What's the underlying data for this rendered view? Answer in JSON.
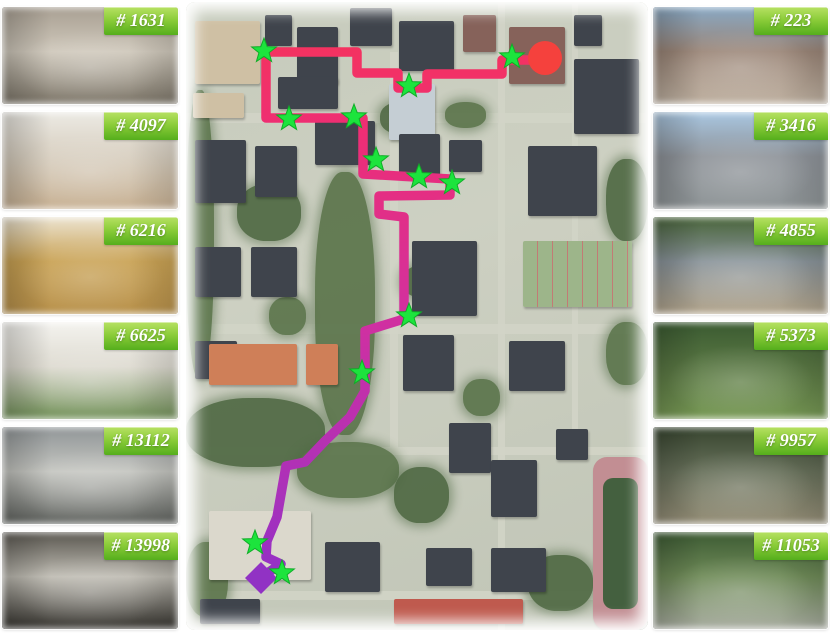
{
  "figure": {
    "background": "#ffffff",
    "badge": {
      "text_color": "#ffffff",
      "gradient": [
        "#b7e163",
        "#8ccd3a",
        "#55ae1c"
      ]
    }
  },
  "left_column": {
    "frames": [
      {
        "id": "# 1631",
        "scene": "old stairwell, stained walls, metal railing",
        "palette": [
          "#a89f92",
          "#cfc8bb",
          "#7b7467"
        ]
      },
      {
        "id": "# 4097",
        "scene": "cafeteria hall with tables and stools",
        "palette": [
          "#eceae4",
          "#d8cfc0",
          "#c7b092"
        ]
      },
      {
        "id": "# 6216",
        "scene": "wood-panel staircase with white railing",
        "palette": [
          "#ece4d2",
          "#c9a254",
          "#b8914b"
        ]
      },
      {
        "id": "# 6625",
        "scene": "bright lobby with ivy planter hedge",
        "palette": [
          "#f4f3ef",
          "#dedbd1",
          "#6f8f55"
        ]
      },
      {
        "id": "# 13112",
        "scene": "columned hall with striped stone floor",
        "palette": [
          "#909597",
          "#c5c6c1",
          "#5e615d"
        ]
      },
      {
        "id": "# 13998",
        "scene": "atrium stair with curved black floor bands",
        "palette": [
          "#59564f",
          "#bfbcb3",
          "#33312c"
        ]
      }
    ]
  },
  "right_column": {
    "frames": [
      {
        "id": "# 223",
        "scene": "street with glass facade and pedestrians",
        "palette": [
          "#88a8c4",
          "#9b8678",
          "#c0b2a2"
        ]
      },
      {
        "id": "# 3416",
        "scene": "road with bicycle and parked cars",
        "palette": [
          "#a9c7e2",
          "#8f949a",
          "#8f9597"
        ]
      },
      {
        "id": "# 4855",
        "scene": "plaza with yellow grid and shared bikes",
        "palette": [
          "#486439",
          "#8a949a",
          "#b3a58c"
        ]
      },
      {
        "id": "# 5373",
        "scene": "park lawn with bronze statue under trees",
        "palette": [
          "#3a5a31",
          "#597743",
          "#789a55"
        ]
      },
      {
        "id": "# 9957",
        "scene": "stone wall and shaded garden path",
        "palette": [
          "#37452f",
          "#67705a",
          "#968f78"
        ]
      },
      {
        "id": "# 11053",
        "scene": "tree-lined campus road with red gateway",
        "palette": [
          "#3c5a33",
          "#6f8b58",
          "#a9ada1"
        ]
      }
    ]
  },
  "map": {
    "viewbox": [
      462,
      628
    ],
    "palette": {
      "dark": "#3f444c",
      "brick": "#86625a",
      "tan": "#cfc0a4",
      "light": "#dbd8cc",
      "paved": "#c5ced4",
      "orange": "#cf7f58",
      "red": "#bf5a4e",
      "tree_a": "#597349",
      "tree_b": "#4d6741",
      "road": "#d2d4c6",
      "court": "#9db58a",
      "court_line": "#c27b75",
      "track": "#c28e93",
      "field": "#44603f"
    },
    "route": {
      "stroke_width": 9.5,
      "gradient": [
        [
          0,
          "#f4335f"
        ],
        [
          0.16,
          "#ee2e74"
        ],
        [
          0.5,
          "#d130a0"
        ],
        [
          0.8,
          "#ad31b8"
        ],
        [
          1,
          "#8f30c8"
        ]
      ],
      "points": [
        [
          351,
          58
        ],
        [
          316,
          58
        ],
        [
          316,
          72
        ],
        [
          241,
          72
        ],
        [
          241,
          86
        ],
        [
          212,
          86
        ],
        [
          212,
          71
        ],
        [
          171,
          71
        ],
        [
          171,
          50
        ],
        [
          80,
          50
        ],
        [
          80,
          116
        ],
        [
          177,
          116
        ],
        [
          177,
          172
        ],
        [
          264,
          177
        ],
        [
          264,
          193
        ],
        [
          193,
          194
        ],
        [
          193,
          212
        ],
        [
          218,
          215
        ],
        [
          218,
          317
        ],
        [
          179,
          329
        ],
        [
          179,
          389
        ],
        [
          164,
          415
        ],
        [
          139,
          439
        ],
        [
          119,
          460
        ],
        [
          100,
          464
        ],
        [
          97,
          481
        ],
        [
          91,
          515
        ],
        [
          81,
          539
        ],
        [
          80,
          555
        ],
        [
          95,
          562
        ],
        [
          77,
          574
        ]
      ]
    },
    "stars": {
      "color": "#1ce43d",
      "edge": "#0fae27",
      "outer_r": 13,
      "inner_r": 5.4,
      "positions": [
        [
          326,
          55
        ],
        [
          223,
          84
        ],
        [
          78,
          49
        ],
        [
          103,
          117
        ],
        [
          168,
          115
        ],
        [
          190,
          158
        ],
        [
          233,
          175
        ],
        [
          266,
          181
        ],
        [
          223,
          314
        ],
        [
          176,
          371
        ],
        [
          69,
          541
        ],
        [
          96,
          571
        ]
      ]
    },
    "start_marker": {
      "shape": "circle",
      "color": "#f5413d",
      "x": 359,
      "y": 56,
      "r": 17
    },
    "end_marker": {
      "shape": "diamond",
      "color": "#9132c4",
      "x": 75,
      "y": 576,
      "s": 16
    },
    "buildings": [
      [
        2,
        3,
        14,
        10,
        "tan"
      ],
      [
        1.5,
        14.5,
        11,
        4,
        "tan"
      ],
      [
        17,
        2,
        6,
        5,
        "dark"
      ],
      [
        24,
        4,
        9,
        9,
        "dark"
      ],
      [
        35.5,
        1,
        9,
        6,
        "dark"
      ],
      [
        46,
        3,
        12,
        8,
        "dark"
      ],
      [
        60,
        2,
        7,
        6,
        "brick"
      ],
      [
        70,
        4,
        12,
        9,
        "brick"
      ],
      [
        84,
        2,
        6,
        5,
        "dark"
      ],
      [
        84,
        9,
        14,
        12,
        "dark"
      ],
      [
        20,
        12,
        13,
        5,
        "dark"
      ],
      [
        28,
        19,
        13,
        7,
        "dark"
      ],
      [
        2,
        22,
        11,
        10,
        "dark"
      ],
      [
        15,
        23,
        9,
        8,
        "dark"
      ],
      [
        44,
        13,
        10,
        9,
        "paved"
      ],
      [
        46,
        21,
        9,
        7,
        "dark"
      ],
      [
        57,
        22,
        7,
        5,
        "dark"
      ],
      [
        74,
        23,
        15,
        11,
        "dark"
      ],
      [
        2,
        39,
        10,
        8,
        "dark"
      ],
      [
        14,
        39,
        10,
        8,
        "dark"
      ],
      [
        49,
        38,
        14,
        12,
        "dark"
      ],
      [
        2,
        54,
        9,
        6,
        "dark"
      ],
      [
        47,
        53,
        11,
        9,
        "dark"
      ],
      [
        70,
        54,
        12,
        8,
        "dark"
      ],
      [
        57,
        67,
        9,
        8,
        "dark"
      ],
      [
        66,
        73,
        10,
        9,
        "dark"
      ],
      [
        80,
        68,
        7,
        5,
        "dark"
      ],
      [
        5,
        81,
        22,
        11,
        "light"
      ],
      [
        30,
        86,
        12,
        8,
        "dark"
      ],
      [
        52,
        87,
        10,
        6,
        "dark"
      ],
      [
        66,
        87,
        12,
        7,
        "dark"
      ],
      [
        3,
        95,
        13,
        4,
        "dark"
      ],
      [
        5,
        54.5,
        19,
        6.5,
        "orange"
      ],
      [
        26,
        54.5,
        7,
        6.5,
        "orange"
      ],
      [
        45,
        95,
        28,
        4,
        "red"
      ]
    ],
    "trees": [
      [
        0,
        14,
        6,
        46
      ],
      [
        11,
        29,
        14,
        9
      ],
      [
        28,
        27,
        13,
        42
      ],
      [
        42,
        16,
        9,
        5
      ],
      [
        56,
        16,
        9,
        4
      ],
      [
        0,
        63,
        30,
        11
      ],
      [
        24,
        70,
        22,
        9
      ],
      [
        45,
        74,
        12,
        9
      ],
      [
        60,
        60,
        8,
        6
      ],
      [
        91,
        25,
        9,
        13
      ],
      [
        91,
        51,
        9,
        10
      ],
      [
        74,
        88,
        14,
        9
      ],
      [
        0,
        86,
        9,
        12
      ],
      [
        47,
        42,
        7,
        5
      ],
      [
        18,
        47,
        8,
        6
      ]
    ],
    "roads": [
      [
        0,
        17.6,
        100,
        1.6
      ],
      [
        0,
        51.3,
        100,
        1.5
      ],
      [
        0,
        70.8,
        100,
        1.4
      ],
      [
        0,
        93.8,
        100,
        1.5
      ],
      [
        44.2,
        8,
        1.6,
        63
      ],
      [
        67.5,
        0,
        1.5,
        100
      ],
      [
        83.5,
        0,
        1.4,
        73
      ]
    ],
    "features": {
      "courts": {
        "x": 73,
        "y": 38,
        "w": 23.5,
        "h": 10.5
      },
      "stadium": {
        "x": 88,
        "y": 72.5,
        "w": 12,
        "h": 27.5
      }
    }
  }
}
